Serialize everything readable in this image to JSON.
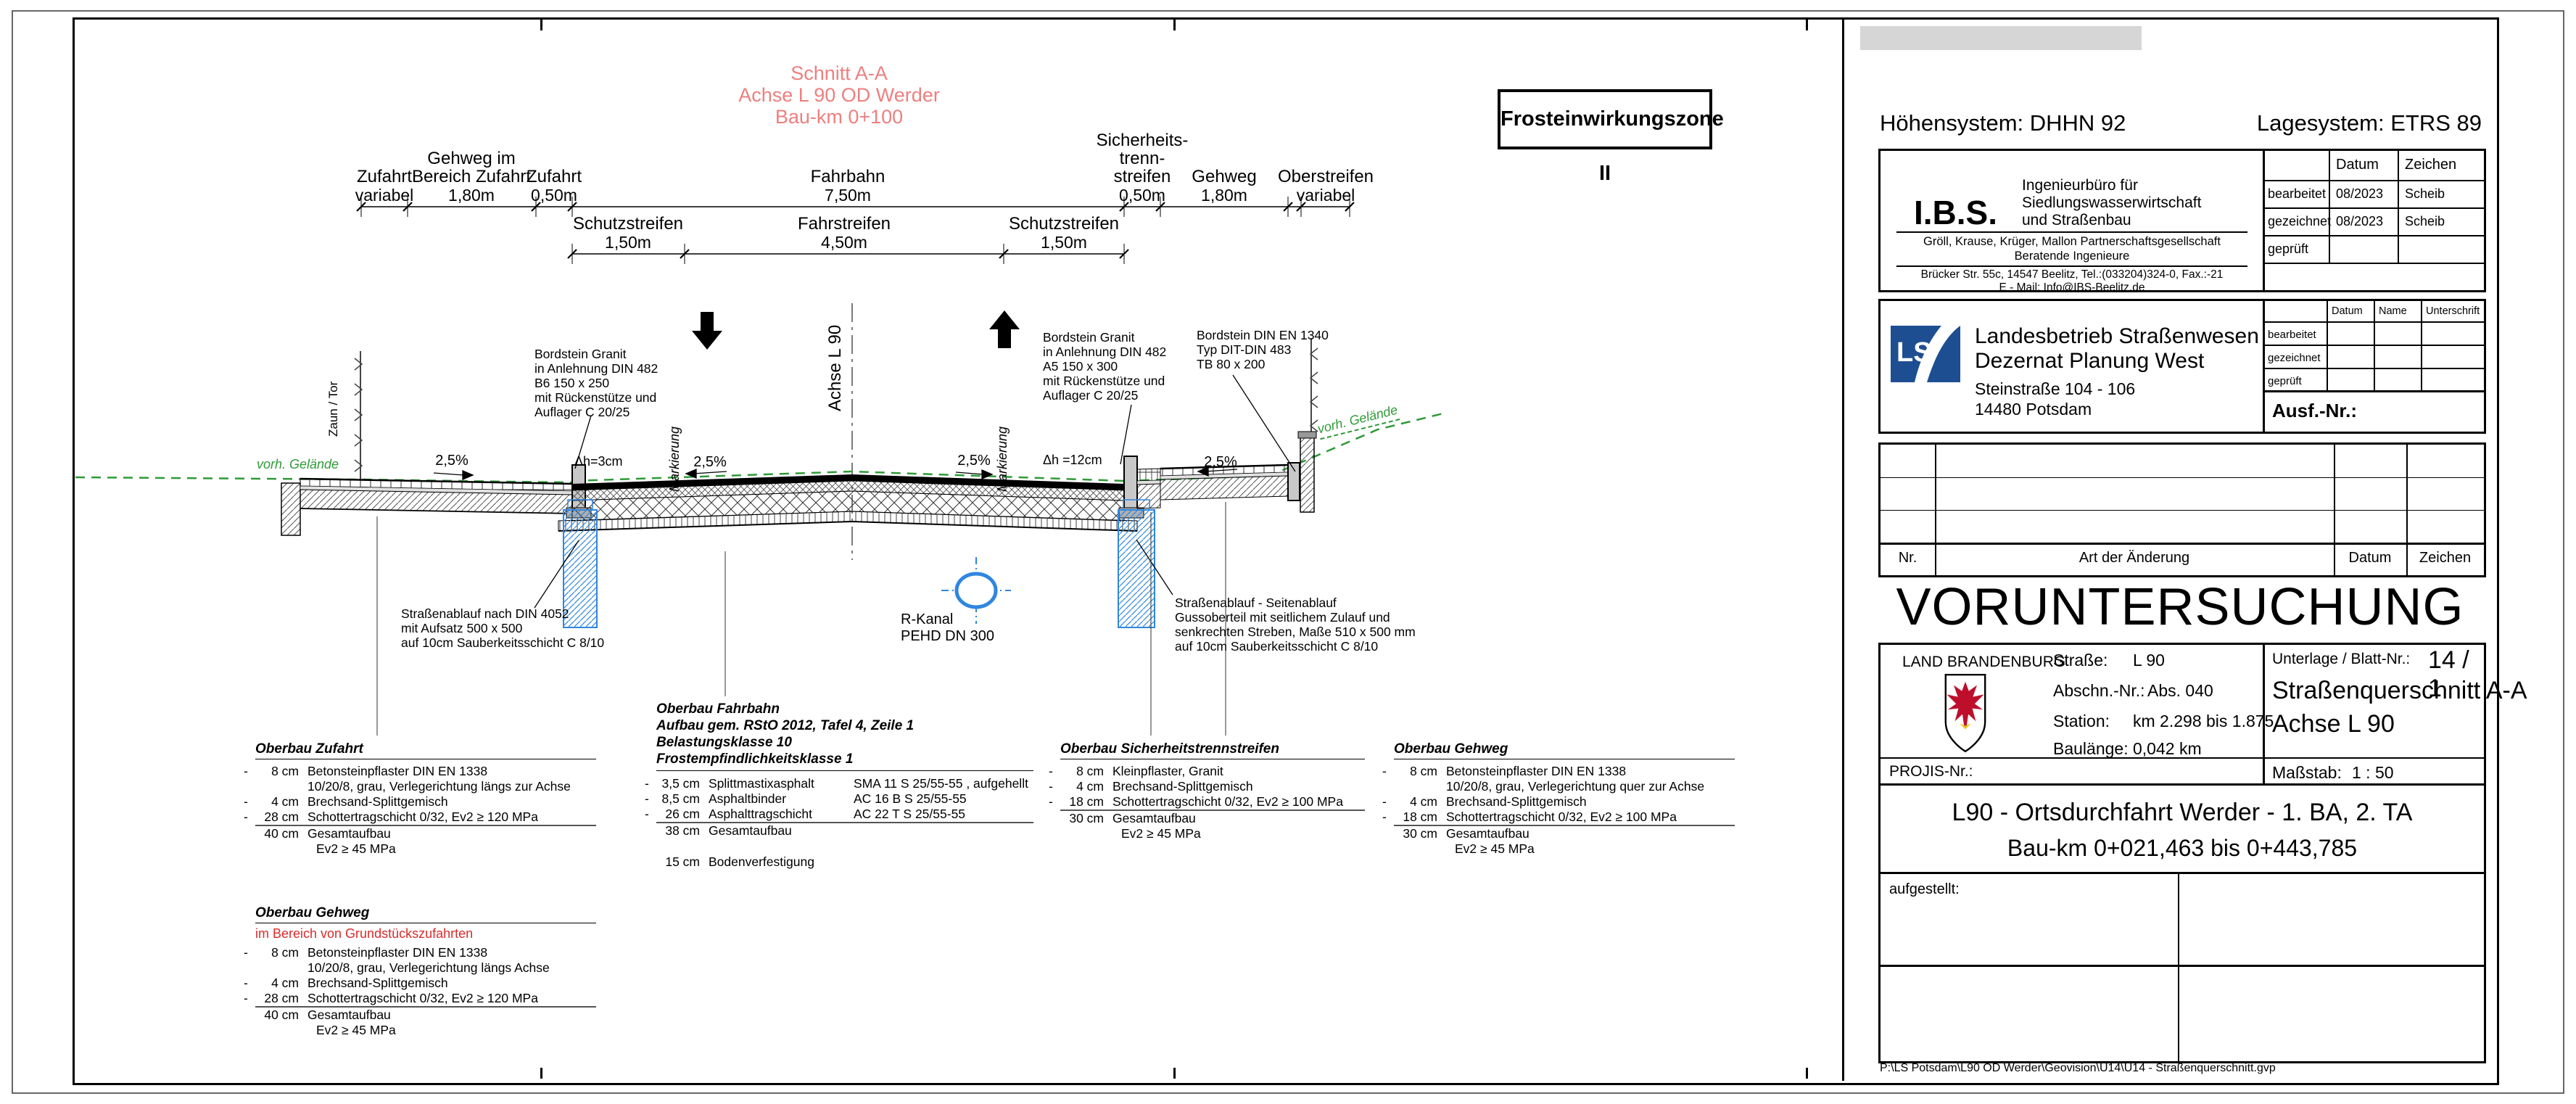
{
  "drawing": {
    "section_title": {
      "l1": "Schnitt A-A",
      "l2": "Achse L 90 OD Werder",
      "l3": "Bau-km 0+100"
    },
    "frost_box": "Frosteinwirkungszone II",
    "dims_row1": [
      {
        "name": "Zufahrt",
        "value": "variabel"
      },
      {
        "name": "Gehweg im",
        "name2": "Bereich Zufahrt",
        "value": "1,80m"
      },
      {
        "name": "Zufahrt",
        "value": "0,50m"
      },
      {
        "name": "Fahrbahn",
        "value": "7,50m"
      },
      {
        "name": "Sicherheits-",
        "name2": "trenn-",
        "name3": "streifen",
        "value": "0,50m"
      },
      {
        "name": "Gehweg",
        "value": "1,80m"
      },
      {
        "name": "Oberstreifen",
        "value": "variabel"
      }
    ],
    "dims_row2": [
      {
        "name": "Schutzstreifen",
        "value": "1,50m"
      },
      {
        "name": "Fahrstreifen",
        "value": "4,50m"
      },
      {
        "name": "Schutzstreifen",
        "value": "1,50m"
      }
    ],
    "axis_label": "Achse L 90",
    "slope1": "2,5%",
    "slope2": "2,5%",
    "slope3": "2,5%",
    "slope4": "2,5%",
    "dh_left": "Δh=3cm",
    "dh_right": "Δh =12cm",
    "marking1": "Markierung",
    "marking2": "Markierung",
    "fence_label": "Zaun / Tor",
    "terrain_left": "vorh. Gelände",
    "terrain_right": "vorh. Gelände",
    "ann_bordstein_left": {
      "l1": "Bordstein Granit",
      "l2": "in Anlehnung DIN 482",
      "l3": "B6 150 x 250",
      "l4": "mit Rückenstütze und",
      "l5": "Auflager C 20/25"
    },
    "ann_bordstein_right": {
      "l1": "Bordstein Granit",
      "l2": "in Anlehnung DIN 482",
      "l3": "A5 150 x 300",
      "l4": "mit Rückenstütze und",
      "l5": "Auflager C 20/25"
    },
    "ann_bordstein_tb": {
      "l1": "Bordstein DIN EN 1340",
      "l2": "Typ DIT-DIN 483",
      "l3": "TB 80 x 200"
    },
    "ann_ablauf_left": {
      "l1": "Straßenablauf nach DIN 4052",
      "l2": "mit Aufsatz 500 x 500",
      "l3": "auf 10cm Sauberkeitsschicht C 8/10"
    },
    "ann_ablauf_right": {
      "l1": "Straßenablauf - Seitenablauf",
      "l2": "Gussoberteil mit seitlichem Zulauf und",
      "l3": "senkrechten Streben, Maße 510 x 500 mm",
      "l4": "auf 10cm Sauberkeitsschicht C 8/10"
    },
    "ann_rkanal": {
      "l1": "R-Kanal",
      "l2": "PEHD DN 300"
    }
  },
  "oberbau": {
    "zufahrt": {
      "title": "Oberbau Zufahrt",
      "r1q": "8 cm",
      "r1t": "Betonsteinpflaster DIN EN 1338",
      "r1c": "10/20/8, grau, Verlegerichtung längs zur Achse",
      "r2q": "4 cm",
      "r2t": "Brechsand-Splittgemisch",
      "r3q": "28 cm",
      "r3t": "Schottertragschicht 0/32, Ev2 ≥ 120 MPa",
      "r4q": "40 cm",
      "r4t": "Gesamtaufbau",
      "r4c": "Ev2 ≥ 45 MPa"
    },
    "fahrbahn": {
      "title": "Oberbau Fahrbahn",
      "sub1": "Aufbau gem. RStO 2012, Tafel 4, Zeile 1",
      "sub2": "Belastungsklasse 10",
      "sub3": "Frostempfindlichkeitsklasse 1",
      "r1q": "3,5 cm",
      "r1m": "Splittmastixasphalt",
      "r1s": "SMA 11 S 25/55-55 , aufgehellt",
      "r2q": "8,5 cm",
      "r2m": "Asphaltbinder",
      "r2s": "AC 16 B S 25/55-55",
      "r3q": "26 cm",
      "r3m": "Asphalttragschicht",
      "r3s": "AC 22 T S 25/55-55",
      "r4q": "38 cm",
      "r4t": "Gesamtaufbau",
      "r5q": "15 cm",
      "r5t": "Bodenverfestigung"
    },
    "sicherheit": {
      "title": "Oberbau Sicherheitstrennstreifen",
      "r1q": "8 cm",
      "r1t": "Kleinpflaster, Granit",
      "r2q": "4 cm",
      "r2t": "Brechsand-Splittgemisch",
      "r3q": "18 cm",
      "r3t": "Schottertragschicht 0/32, Ev2 ≥ 100 MPa",
      "r4q": "30 cm",
      "r4t": "Gesamtaufbau",
      "r4c": "Ev2 ≥ 45 MPa"
    },
    "gehweg": {
      "title": "Oberbau Gehweg",
      "r1q": "8 cm",
      "r1t": "Betonsteinpflaster DIN EN 1338",
      "r1c": "10/20/8, grau, Verlegerichtung quer zur Achse",
      "r2q": "4 cm",
      "r2t": "Brechsand-Splittgemisch",
      "r3q": "18 cm",
      "r3t": "Schottertragschicht 0/32, Ev2 ≥ 100 MPa",
      "r4q": "30 cm",
      "r4t": "Gesamtaufbau",
      "r4c": "Ev2 ≥ 45 MPa"
    },
    "gehweg_zufahrten": {
      "title": "Oberbau Gehweg",
      "subtitle": "im Bereich von Grundstückszufahrten",
      "r1q": "8 cm",
      "r1t": "Betonsteinpflaster DIN EN 1338",
      "r1c": "10/20/8, grau, Verlegerichtung längs Achse",
      "r2q": "4 cm",
      "r2t": "Brechsand-Splittgemisch",
      "r3q": "28 cm",
      "r3t": "Schottertragschicht 0/32, Ev2 ≥ 120 MPa",
      "r4q": "40 cm",
      "r4t": "Gesamtaufbau",
      "r4c": "Ev2 ≥ 45 MPa"
    }
  },
  "titleblock": {
    "hoehensystem": "Höhensystem: DHHN 92",
    "lagesystem": "Lagesystem: ETRS 89",
    "ibs": {
      "logo": "I.B.S.",
      "line1": "Ingenieurbüro für",
      "line2": "Siedlungswasserwirtschaft",
      "line3": "und Straßenbau",
      "partners": "Gröll, Krause, Krüger, Mallon Partnerschaftsgesellschaft",
      "beratende": "Beratende Ingenieure",
      "address": "Brücker Str. 55c, 14547 Beelitz, Tel.:(033204)324-0, Fax.:-21",
      "email": "E - Mail: Info@IBS-Beelitz.de",
      "col_datum": "Datum",
      "col_zeichen": "Zeichen",
      "row1_label": "bearbeitet",
      "row1_datum": "08/2023",
      "row1_zeichen": "Scheib",
      "row2_label": "gezeichnet",
      "row2_datum": "08/2023",
      "row2_zeichen": "Scheib",
      "row3_label": "geprüft",
      "row3_datum": "",
      "row3_zeichen": ""
    },
    "ls": {
      "logo": "LS",
      "name1": "Landesbetrieb Straßenwesen",
      "name2": "Dezernat Planung West",
      "addr1": "Steinstraße 104 - 106",
      "addr2": "14480 Potsdam",
      "col_datum": "Datum",
      "col_name": "Name",
      "col_unterschrift": "Unterschrift",
      "row1": "bearbeitet",
      "row2": "gezeichnet",
      "row3": "geprüft",
      "ausf": "Ausf.-Nr.:"
    },
    "revision": {
      "nr": "Nr.",
      "art": "Art der Änderung",
      "datum": "Datum",
      "zeichen": "Zeichen"
    },
    "main_title": "VORUNTERSUCHUNG",
    "project": {
      "land": "LAND BRANDENBURG",
      "strasse_label": "Straße:",
      "strasse": "L 90",
      "abschn_label": "Abschn.-Nr.:",
      "abschn": "Abs. 040",
      "station_label": "Station:",
      "station": "km 2.298 bis 1.875",
      "baulaenge_label": "Baulänge:",
      "baulaenge": "0,042 km",
      "projis": "PROJIS-Nr.:",
      "unterlage_label": "Unterlage / Blatt-Nr.:",
      "unterlage": "14 / 1",
      "querschnitt1": "Straßenquerschnitt A-A",
      "querschnitt2": "Achse L 90",
      "massstab_label": "Maßstab:",
      "massstab": "1 : 50",
      "proj1": "L90 - Ortsdurchfahrt Werder - 1. BA, 2. TA",
      "proj2": "Bau-km 0+021,463 bis 0+443,785",
      "aufgestellt": "aufgestellt:"
    },
    "path": "P:\\LS Potsdam\\L90 OD Werder\\Geovision\\U14\\U14 - Straßenquerschnitt.gvp"
  }
}
